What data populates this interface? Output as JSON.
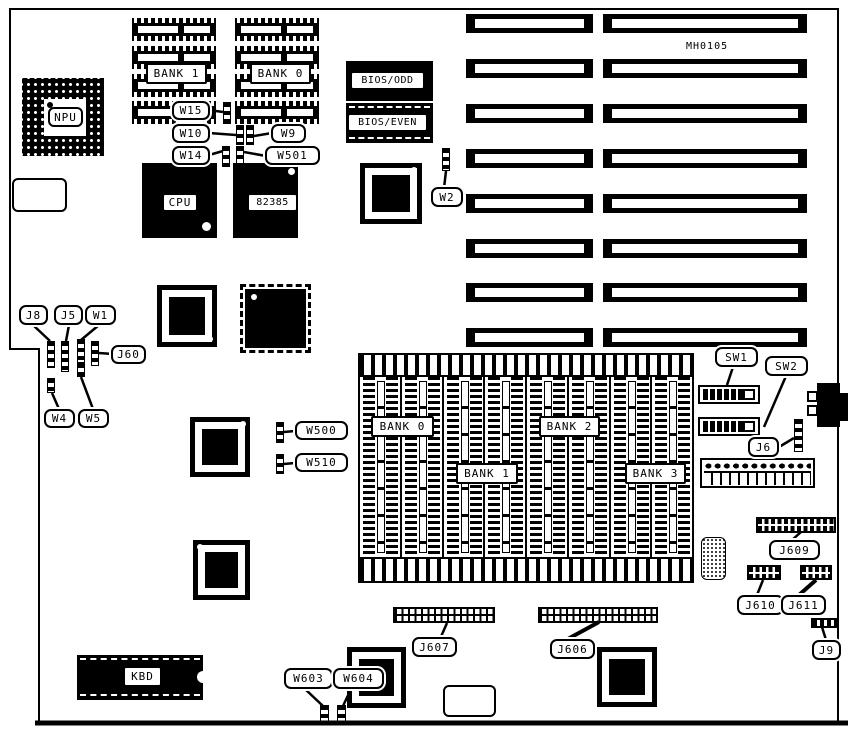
{
  "board": {
    "model_number": "MH0105"
  },
  "chips": {
    "npu": "NPU",
    "cpu": "CPU",
    "cache_controller": "82385",
    "bios_odd": "BIOS/ODD",
    "bios_even": "BIOS/EVEN",
    "keyboard_controller": "KBD"
  },
  "dip_memory_banks": {
    "bank1": "BANK 1",
    "bank0": "BANK 0"
  },
  "simm_memory_banks": {
    "bank0": "BANK 0",
    "bank1": "BANK 1",
    "bank2": "BANK 2",
    "bank3": "BANK 3"
  },
  "jumpers": {
    "w15": "W15",
    "w10": "W10",
    "w9": "W9",
    "w14": "W14",
    "w501": "W501",
    "w2": "W2",
    "w500": "W500",
    "w510": "W510",
    "w1": "W1",
    "w4": "W4",
    "w5": "W5",
    "w603": "W603",
    "w604": "W604"
  },
  "connectors": {
    "j8": "J8",
    "j5": "J5",
    "j60": "J60",
    "j6": "J6",
    "j9": "J9",
    "j606": "J606",
    "j607": "J607",
    "j609": "J609",
    "j610": "J610",
    "j611": "J611"
  },
  "switches": {
    "sw1": "SW1",
    "sw2": "SW2"
  },
  "colors": {
    "ink": "#000000",
    "background": "#ffffff"
  }
}
